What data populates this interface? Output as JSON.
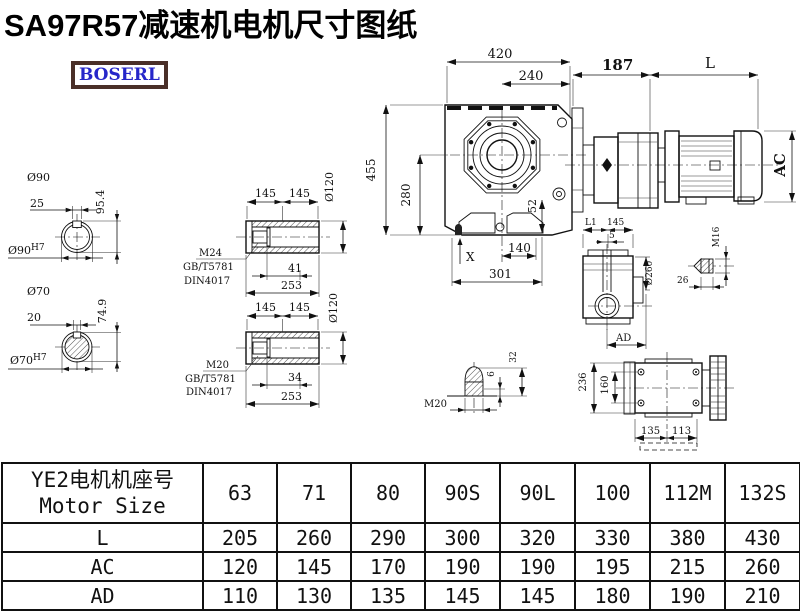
{
  "title": "SA97R57减速机电机尺寸图纸",
  "logo": "BOSERL",
  "drawing": {
    "shaft1": {
      "dia": "Ø90",
      "key": "25",
      "height": "95.4",
      "bore": "Ø90",
      "bore_sup": "H7"
    },
    "shaft2": {
      "dia": "Ø70",
      "key": "20",
      "height": "74.9",
      "bore": "Ø70",
      "bore_sup": "H7"
    },
    "hollow1": {
      "seg1": "145",
      "seg2": "145",
      "dia": "Ø120",
      "thread": "M24",
      "std1": "GB/T5781",
      "std2": "DIN4017",
      "depth": "41",
      "length": "253"
    },
    "hollow2": {
      "seg1": "145",
      "seg2": "145",
      "dia": "Ø120",
      "thread": "M20",
      "std1": "GB/T5781",
      "std2": "DIN4017",
      "depth": "34",
      "length": "253"
    },
    "front": {
      "width": "420",
      "width2": "240",
      "height": "455",
      "height2": "280",
      "offset": "52",
      "base": "140",
      "total": "301",
      "xmark": "X"
    },
    "motor": {
      "flange": "187",
      "length": "L",
      "dia": "AC"
    },
    "side": {
      "l1": "L1",
      "seg": "145",
      "gap": "5",
      "dia": "Ø260",
      "ad": "AD"
    },
    "plug16": {
      "thread": "M16",
      "length": "26"
    },
    "plug20": {
      "thread": "M20",
      "tip": "6",
      "length": "32"
    },
    "topview": {
      "height": "236",
      "inner": "160",
      "left": "135",
      "right": "113"
    }
  },
  "table": {
    "header_cn": "YE2电机机座号",
    "header_en": "Motor Size",
    "columns": [
      "63",
      "71",
      "80",
      "90S",
      "90L",
      "100",
      "112M",
      "132S"
    ],
    "rows": [
      {
        "label": "L",
        "values": [
          "205",
          "260",
          "290",
          "300",
          "320",
          "330",
          "380",
          "430"
        ]
      },
      {
        "label": "AC",
        "values": [
          "120",
          "145",
          "170",
          "190",
          "190",
          "195",
          "215",
          "260"
        ]
      },
      {
        "label": "AD",
        "values": [
          "110",
          "130",
          "135",
          "145",
          "145",
          "180",
          "190",
          "210"
        ]
      }
    ]
  }
}
